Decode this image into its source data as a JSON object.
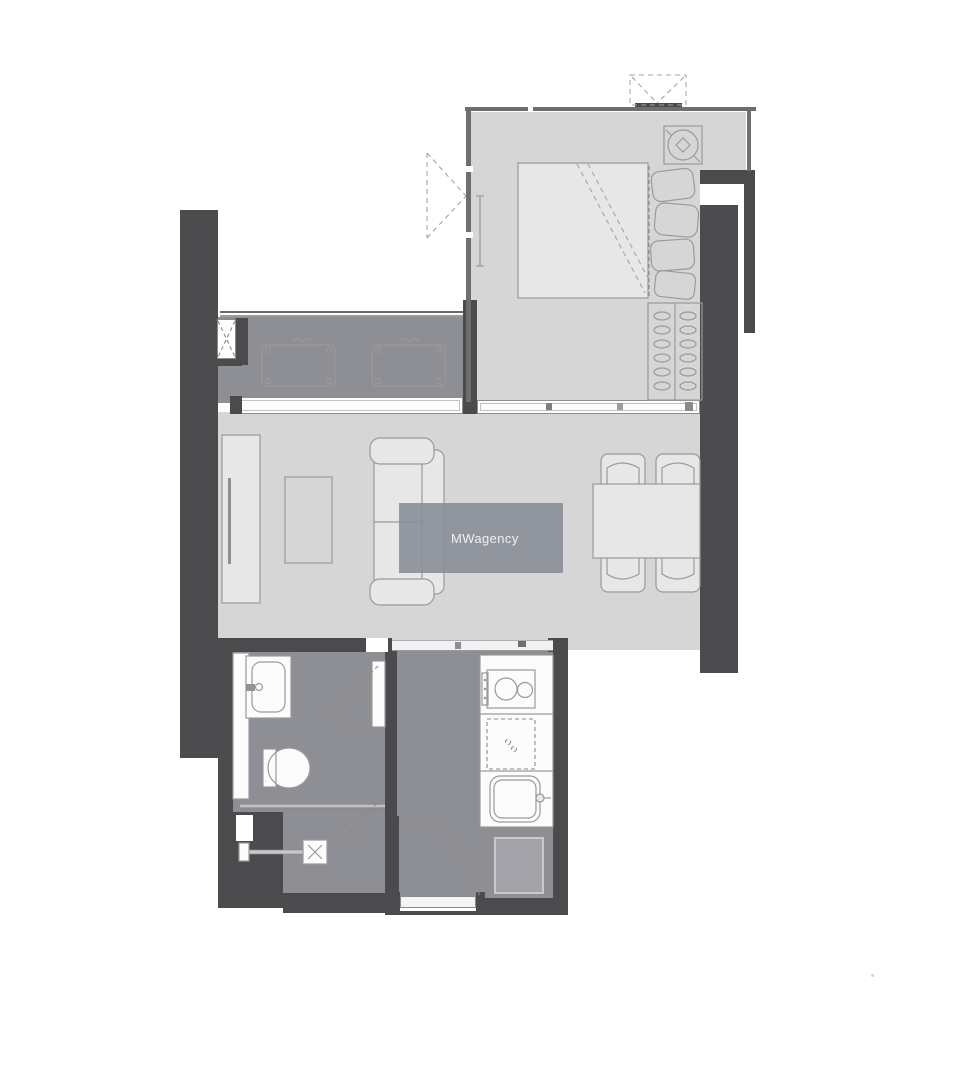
{
  "watermark": {
    "label": "MWagency"
  },
  "colors": {
    "canvas_bg": "#ffffff",
    "wall": "#4b4b4d",
    "floor_light": "#d6d6d6",
    "floor_mid": "#8e8e95",
    "fixture_white": "#fcfcfc",
    "outline": "#9a9a9a",
    "watermark_bg": "rgba(136,140,150,0.88)",
    "watermark_text": "#eef0f2"
  }
}
